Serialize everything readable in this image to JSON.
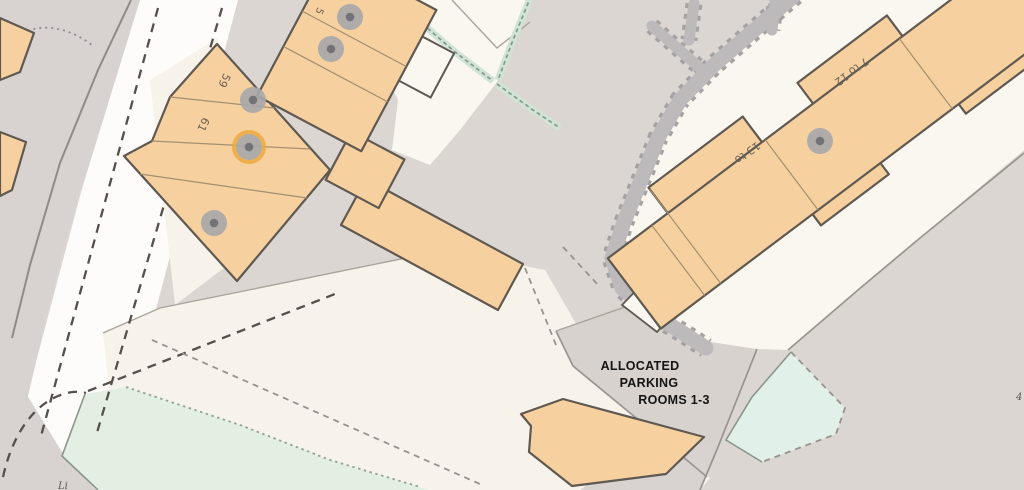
{
  "map": {
    "labels": {
      "building_59": "59",
      "building_61": "61",
      "building_5_partial": "5",
      "building_7_to_12": "7 to 12",
      "building_13_to": "13 to"
    },
    "annotation": {
      "line1": "ALLOCATED",
      "line2": "PARKING",
      "line3": "ROOMS 1-3"
    },
    "partial": {
      "bottom_left": "Li",
      "right_edge": "4"
    },
    "markers": [
      {
        "x": 350,
        "y": 17,
        "highlighted": false
      },
      {
        "x": 331,
        "y": 49,
        "highlighted": false
      },
      {
        "x": 253,
        "y": 100,
        "highlighted": false
      },
      {
        "x": 249,
        "y": 147,
        "highlighted": true
      },
      {
        "x": 214,
        "y": 223,
        "highlighted": false
      },
      {
        "x": 820,
        "y": 141,
        "highlighted": false
      }
    ],
    "colors": {
      "background": "#dbd6d2",
      "road": "#fdfcfa",
      "plot_cream": "#f7f3ea",
      "building_fill": "#f7d0a0",
      "building_outline": "#5f5951",
      "footpath": "#bdbabc",
      "green_area": "#e3efe2",
      "marker_gray": "#a7a7a9",
      "marker_highlight_ring": "#edaa3c",
      "annotation_text": "#141414",
      "label_text": "#6b6152"
    }
  }
}
